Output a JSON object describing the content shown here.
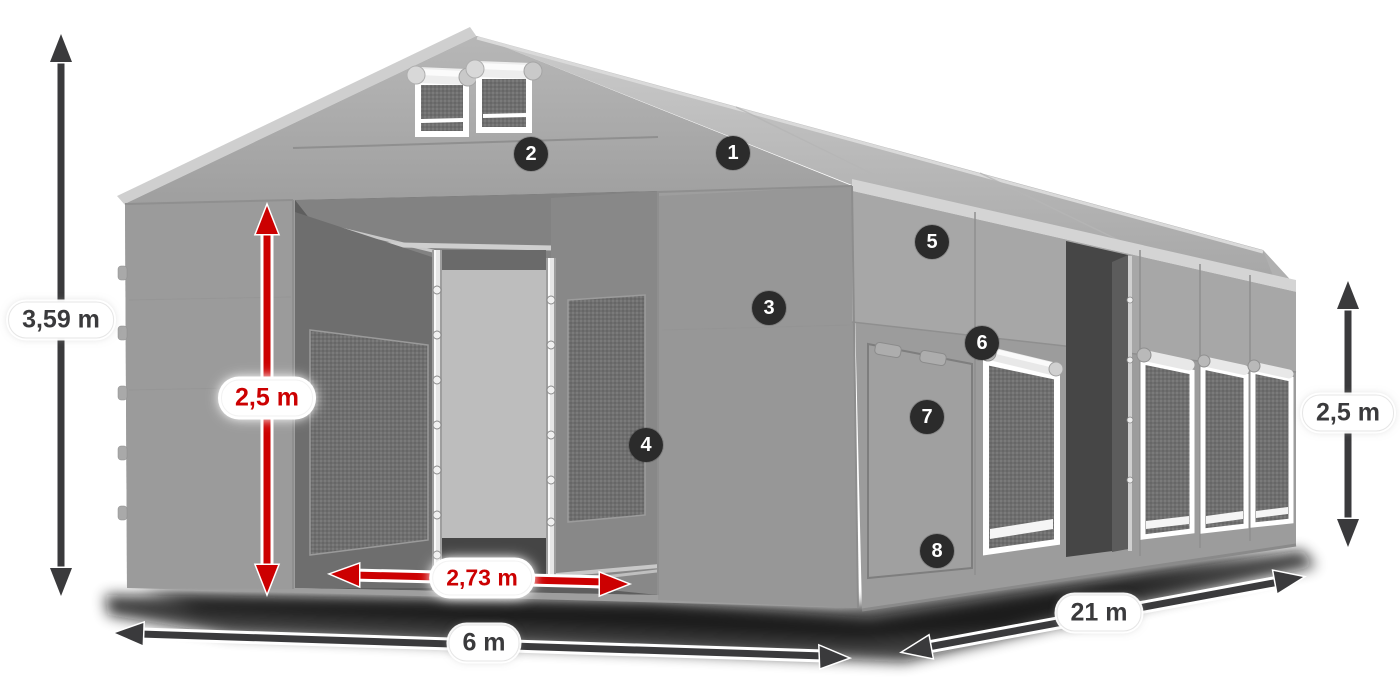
{
  "badges": [
    {
      "number": "1"
    },
    {
      "number": "2"
    },
    {
      "number": "3"
    },
    {
      "number": "4"
    },
    {
      "number": "5"
    },
    {
      "number": "6"
    },
    {
      "number": "7"
    },
    {
      "number": "8"
    }
  ],
  "dimensions": {
    "total_height": {
      "label": "3,59 m"
    },
    "entrance_height": {
      "label": "2,5 m"
    },
    "entrance_width": {
      "label": "2,73 m"
    },
    "width": {
      "label": "6 m"
    },
    "length": {
      "label": "21 m"
    },
    "side_height": {
      "label": "2,5 m"
    }
  },
  "colors": {
    "dimension_red": "#cc0001",
    "dimension_dark": "#3a3a3c",
    "badge_background": "#2b2b2b",
    "tent_gray": "#9e9e9e",
    "roof_light": "#c9c9c9",
    "background": "#ffffff"
  }
}
